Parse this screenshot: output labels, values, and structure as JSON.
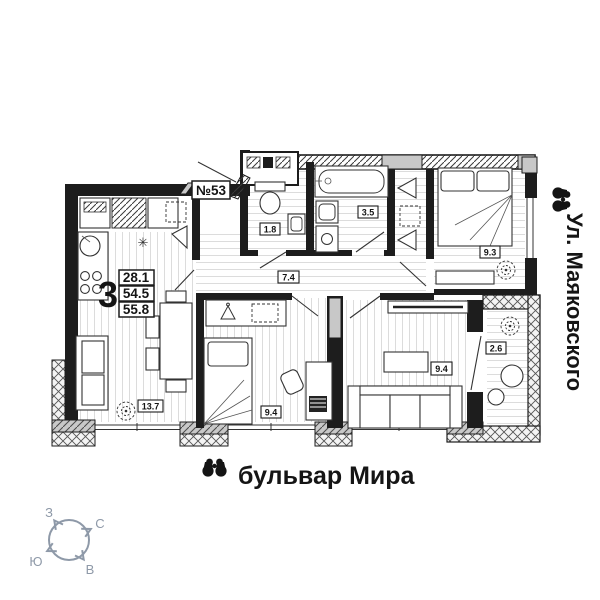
{
  "colors": {
    "wall": "#1d1d1d",
    "hatch_gray": "#c8c8c8",
    "floor_line": "#dcdcdc",
    "compass": "#8e99a8",
    "ink": "#141414"
  },
  "apartment": {
    "number": "№53",
    "rooms_count": "3",
    "living_area": "28.1",
    "area": "54.5",
    "total_area": "55.8"
  },
  "rooms": [
    {
      "name": "kitchen-living-room",
      "area": "13.7"
    },
    {
      "name": "bedroom-1",
      "area": "9.4"
    },
    {
      "name": "living-room",
      "area": "9.4"
    },
    {
      "name": "bedroom-2",
      "area": "9.3"
    },
    {
      "name": "hallway",
      "area": "7.4"
    },
    {
      "name": "wc",
      "area": "1.8"
    },
    {
      "name": "bathroom",
      "area": "3.5"
    },
    {
      "name": "balcony",
      "area": "2.6"
    }
  ],
  "streets": {
    "bottom": "бульвар Мира",
    "right": "Ул. Маяковского"
  },
  "compass": {
    "north": "С",
    "south": "Ю",
    "west": "З",
    "east": "В"
  },
  "icons": {
    "fridge": "✳"
  }
}
